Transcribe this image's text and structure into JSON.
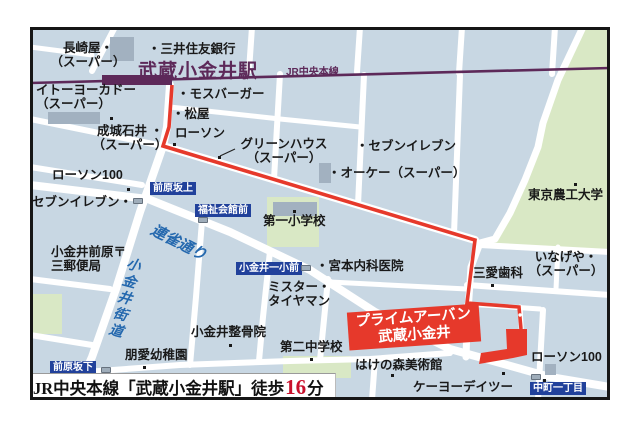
{
  "map": {
    "station_name": "武蔵小金井駅",
    "rail_line_label": "JR中央本線",
    "destination_badge": {
      "line1": "プライムアーバン",
      "line2": "武蔵小金井"
    },
    "caption": {
      "text_before": "JR中央本線「武蔵小金井駅」徒歩",
      "minutes": "16",
      "text_after": "分"
    },
    "streets": [
      {
        "name": "連雀通り",
        "x": 127,
        "y": 192,
        "rot": 27,
        "size": 15,
        "vertical": false
      },
      {
        "name": "小金井街道",
        "x": 96,
        "y": 228,
        "rot": 15,
        "size": 14,
        "vertical": true
      }
    ],
    "bus_stops": [
      {
        "name": "前原坂上",
        "x": 120,
        "y": 155,
        "icon_x": 103,
        "icon_y": 171
      },
      {
        "name": "福祉会館前",
        "x": 165,
        "y": 177,
        "icon_x": 168,
        "icon_y": 190
      },
      {
        "name": "小金井一小前",
        "x": 206,
        "y": 235,
        "icon_x": 271,
        "icon_y": 238
      },
      {
        "name": "前原坂下",
        "x": 20,
        "y": 334,
        "icon_x": 71,
        "icon_y": 340
      },
      {
        "name": "中町一丁目",
        "x": 500,
        "y": 355,
        "icon_x": 501,
        "icon_y": 347
      }
    ],
    "poi_labels": [
      {
        "text": "長崎屋・\n（スーパー）",
        "x": 3,
        "y": 14,
        "w": 110,
        "align": "center"
      },
      {
        "text": "・三井住友銀行",
        "x": 118,
        "y": 15
      },
      {
        "text": "イトーヨーカドー\n（スーパー）",
        "x": 6,
        "y": 56,
        "align": "left"
      },
      {
        "text": "・モスバーガー",
        "x": 147,
        "y": 60
      },
      {
        "text": "・松屋",
        "x": 142,
        "y": 80
      },
      {
        "text": "成城石井 ・\n（スーパー）",
        "x": 58,
        "y": 97,
        "w": 84,
        "align": "center"
      },
      {
        "text": "ローソン",
        "x": 145,
        "y": 99
      },
      {
        "text": "グリーンハウス\n（スーパー）",
        "x": 206,
        "y": 110,
        "w": 96,
        "align": "center"
      },
      {
        "text": "・セブンイレブン",
        "x": 326,
        "y": 112
      },
      {
        "text": "・オーケー（スーパー）",
        "x": 298,
        "y": 139
      },
      {
        "text": "東京農工大学",
        "x": 498,
        "y": 161
      },
      {
        "text": "ローソン100",
        "x": 22,
        "y": 141
      },
      {
        "text": "セブンイレブン・",
        "x": 2,
        "y": 168
      },
      {
        "text": "小金井前原〒\n三郵便局",
        "x": 21,
        "y": 218,
        "align": "left"
      },
      {
        "text": "第一小学校",
        "x": 233,
        "y": 187
      },
      {
        "text": "・宮本内科医院",
        "x": 286,
        "y": 232
      },
      {
        "text": "いなげや・\n（スーパー）",
        "x": 498,
        "y": 223,
        "w": 76,
        "align": "center"
      },
      {
        "text": "三愛歯科",
        "x": 443,
        "y": 239
      },
      {
        "text": "ミスター・\nタイヤマン",
        "x": 238,
        "y": 253,
        "align": "left"
      },
      {
        "text": "小金井整骨院",
        "x": 161,
        "y": 298
      },
      {
        "text": "第二中学校",
        "x": 250,
        "y": 313
      },
      {
        "text": "朋愛幼稚園",
        "x": 95,
        "y": 321
      },
      {
        "text": "はけの森美術館",
        "x": 325,
        "y": 331
      },
      {
        "text": "ケーヨーデイツー",
        "x": 383,
        "y": 353
      },
      {
        "text": "ローソン100",
        "x": 501,
        "y": 323
      }
    ],
    "poi_dots": [
      {
        "x": 143,
        "y": 116
      },
      {
        "x": 97,
        "y": 161
      },
      {
        "x": 544,
        "y": 156
      },
      {
        "x": 263,
        "y": 183
      },
      {
        "x": 461,
        "y": 257
      },
      {
        "x": 199,
        "y": 317
      },
      {
        "x": 280,
        "y": 331
      },
      {
        "x": 113,
        "y": 339
      },
      {
        "x": 361,
        "y": 347
      },
      {
        "x": 472,
        "y": 345
      },
      {
        "x": 513,
        "y": 352
      },
      {
        "x": 80,
        "y": 90
      },
      {
        "x": 188,
        "y": 129
      }
    ],
    "colors": {
      "route": "#e6392b",
      "railway": "#5d2959",
      "bus_stop_badge": "#21419b",
      "street_name": "#2468ae",
      "destination_badge": "#e6392b",
      "minutes_red": "#c9112c",
      "block_fill": "#c8d7e3",
      "green_area": "#d9e8c5"
    }
  }
}
